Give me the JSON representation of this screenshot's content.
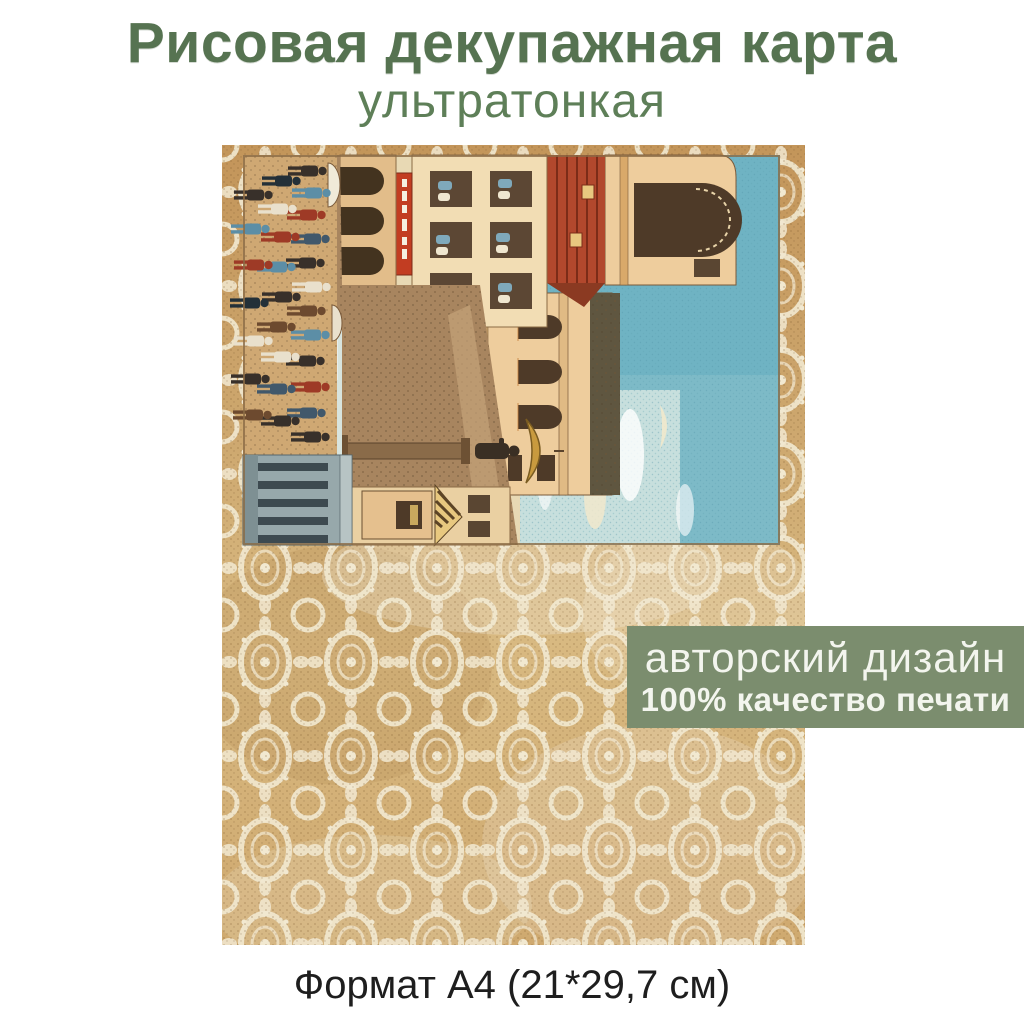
{
  "page": {
    "background_color": "#ffffff"
  },
  "header": {
    "title": "Рисовая декупажная карта",
    "title_color": "#567351",
    "subtitle": "ультратонкая",
    "subtitle_color": "#5e7f58"
  },
  "badge": {
    "line1": "авторский дизайн",
    "line2": "100% качество печати",
    "background_color": "#7b8d6e",
    "text_color": "#f3f5ee"
  },
  "footer": {
    "format_label": "Формат А4 (21*29,7 см)",
    "text_color": "#1e1e1e"
  },
  "sheet": {
    "description": "Rice decoupage paper sheet: golden lace background with a vintage town-square chromolithograph printed sideways (rotated 90°)",
    "lace_colors": {
      "base": "#c99e63",
      "base_light": "#dcc08c",
      "motif": "#f2e9d1"
    },
    "illustration_colors": {
      "sky": "#6fb3c3",
      "light_sky": "#d3e5e0",
      "walls": "#eecd9d",
      "red_roof": "#b2482d",
      "dark_roof": "#5f5640",
      "crowd": "#38302a",
      "colonnade": "#97a8ab",
      "umbrella": "#c89a3e"
    }
  }
}
